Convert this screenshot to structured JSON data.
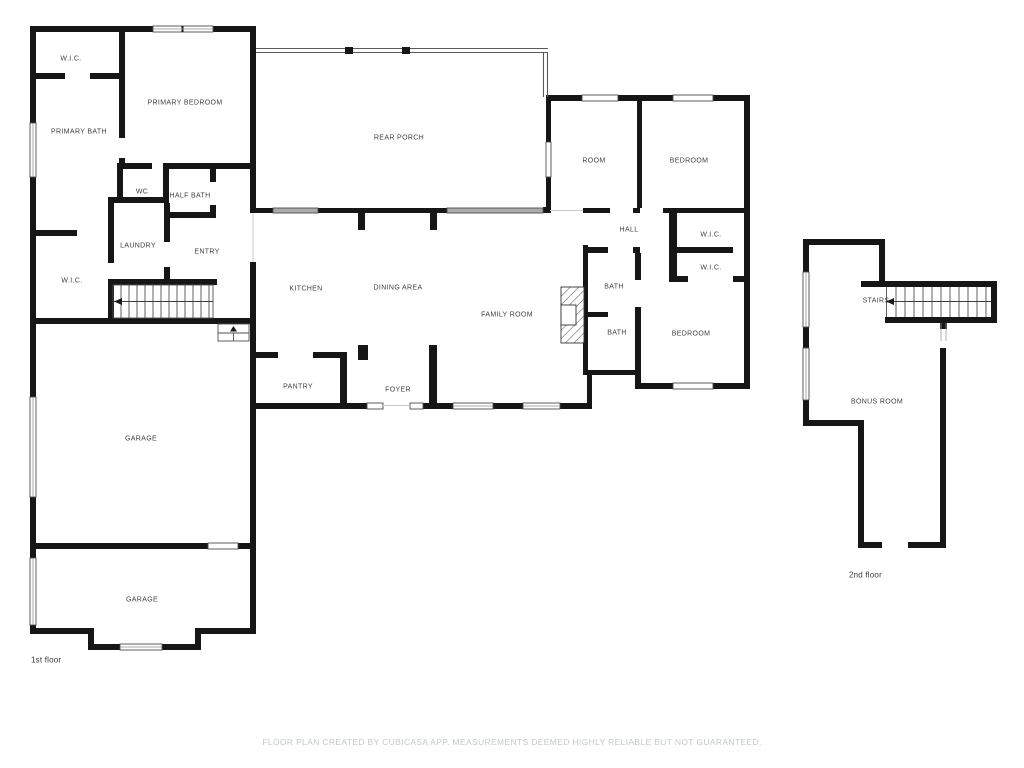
{
  "document": {
    "type": "floor-plan",
    "disclaimer": "FLOOR PLAN CREATED BY CUBICASA APP. MEASUREMENTS DEEMED HIGHLY RELIABLE BUT NOT GUARANTEED."
  },
  "colors": {
    "wall": "#161616",
    "window_frame": "#4d4d4d",
    "window_glass": "#ffffff",
    "porch_screen": "#5a5a5a",
    "stair_line": "#4f4f4f",
    "label_text": "#3f3f3f",
    "disclaimer_text": "#c3c8cc"
  },
  "floor1": {
    "caption": "1st floor",
    "rooms": {
      "wic_top": {
        "label": "W.I.C."
      },
      "primary_bedroom": {
        "label": "PRIMARY BEDROOM"
      },
      "primary_bath": {
        "label": "PRIMARY BATH"
      },
      "rear_porch": {
        "label": "REAR PORCH"
      },
      "room": {
        "label": "ROOM"
      },
      "bedroom_top": {
        "label": "BEDROOM"
      },
      "wc": {
        "label": "WC"
      },
      "half_bath": {
        "label": "HALF BATH"
      },
      "hall": {
        "label": "HALL"
      },
      "wic_right1": {
        "label": "W.I.C."
      },
      "laundry": {
        "label": "LAUNDRY"
      },
      "entry": {
        "label": "ENTRY"
      },
      "wic_right2": {
        "label": "W.I.C."
      },
      "wic_left": {
        "label": "W.I.C."
      },
      "kitchen": {
        "label": "KITCHEN"
      },
      "dining_area": {
        "label": "DINING AREA"
      },
      "bath_upper": {
        "label": "BATH"
      },
      "family_room": {
        "label": "FAMILY ROOM"
      },
      "bath_lower": {
        "label": "BATH"
      },
      "bedroom_right": {
        "label": "BEDROOM"
      },
      "pantry": {
        "label": "PANTRY"
      },
      "foyer": {
        "label": "FOYER"
      },
      "garage_main": {
        "label": "GARAGE"
      },
      "garage_front": {
        "label": "GARAGE"
      }
    }
  },
  "floor2": {
    "caption": "2nd floor",
    "rooms": {
      "stairs": {
        "label": "STAIRS"
      },
      "bonus_room": {
        "label": "BONUS ROOM"
      }
    }
  }
}
